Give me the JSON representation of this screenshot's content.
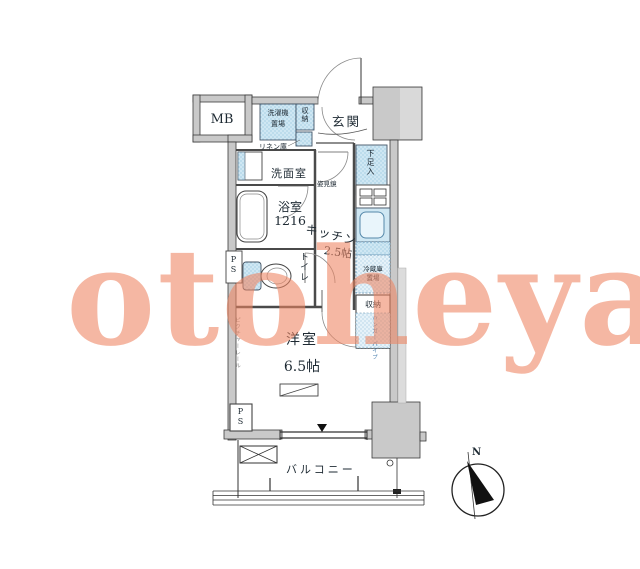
{
  "watermark": {
    "text": "otoheya",
    "color": "#ee8562"
  },
  "plan": {
    "labels": {
      "mb": "MB",
      "entrance": "玄関",
      "laundry_l1": "洗濯機",
      "laundry_l2": "置場",
      "hall_storage": "収納",
      "linen": "リネン庫",
      "washroom": "洗面室",
      "mirror": "姿見鏡",
      "shoe_cabinet": "下足入",
      "bath_name": "浴室",
      "bath_size": "1216",
      "kitchen_name": "キッチン",
      "kitchen_size": "2.5帖",
      "toilet": "トイレ",
      "ps_top": "PS",
      "ps_bottom": "PS",
      "fridge_l1": "冷蔵庫",
      "fridge_l2": "置場",
      "kitchen_storage": "収納",
      "hanger_pipe": "ハンガーパイプ",
      "picture_rail": "ピクチャーレール",
      "room_name": "洋室",
      "room_size": "6.5帖",
      "balcony": "バルコニー",
      "north": "N"
    },
    "colors": {
      "wall_gray": "#c9c9c9",
      "wall_gray_light": "#d9d9d9",
      "fixture_blue": "#cfe7f3",
      "accent_blue": "#5b8fb5",
      "line_dark": "#3a3a3a"
    }
  }
}
